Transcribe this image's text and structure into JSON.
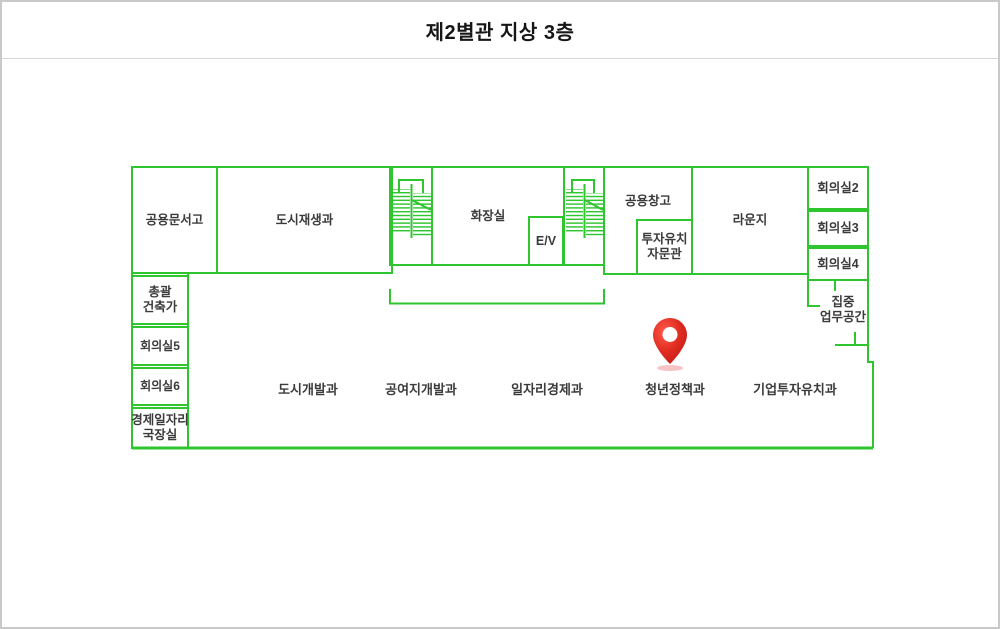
{
  "page": {
    "title": "제2별관 지상 3층"
  },
  "colors": {
    "line-green": "#2ec52e",
    "label-dark": "#3b3b3b",
    "pin-red": "#e02b20",
    "pin-shadow": "#f5b8bd",
    "border-gray": "#c9c9c9"
  },
  "rooms": {
    "shared_archive": "공용문서고",
    "urban_regeneration": "도시재생과",
    "restroom": "화장실",
    "elevator": "E/V",
    "shared_storage": "공용창고",
    "investment_advisor": "투자유치\n자문관",
    "lounge": "라운지",
    "meeting2": "회의실2",
    "meeting3": "회의실3",
    "meeting4": "회의실4",
    "focus_workspace": "집중\n업무공간",
    "chief_architect": "총괄\n건축가",
    "meeting5": "회의실5",
    "meeting6": "회의실6",
    "econ_jobs_director": "경제일자리\n국장실"
  },
  "areas": {
    "urban_development": "도시개발과",
    "donated_land_development": "공여지개발과",
    "job_economy": "일자리경제과",
    "youth_policy": "청년정책과",
    "business_investment": "기업투자유치과"
  },
  "icons": {
    "location_pin": "red-map-pin"
  }
}
